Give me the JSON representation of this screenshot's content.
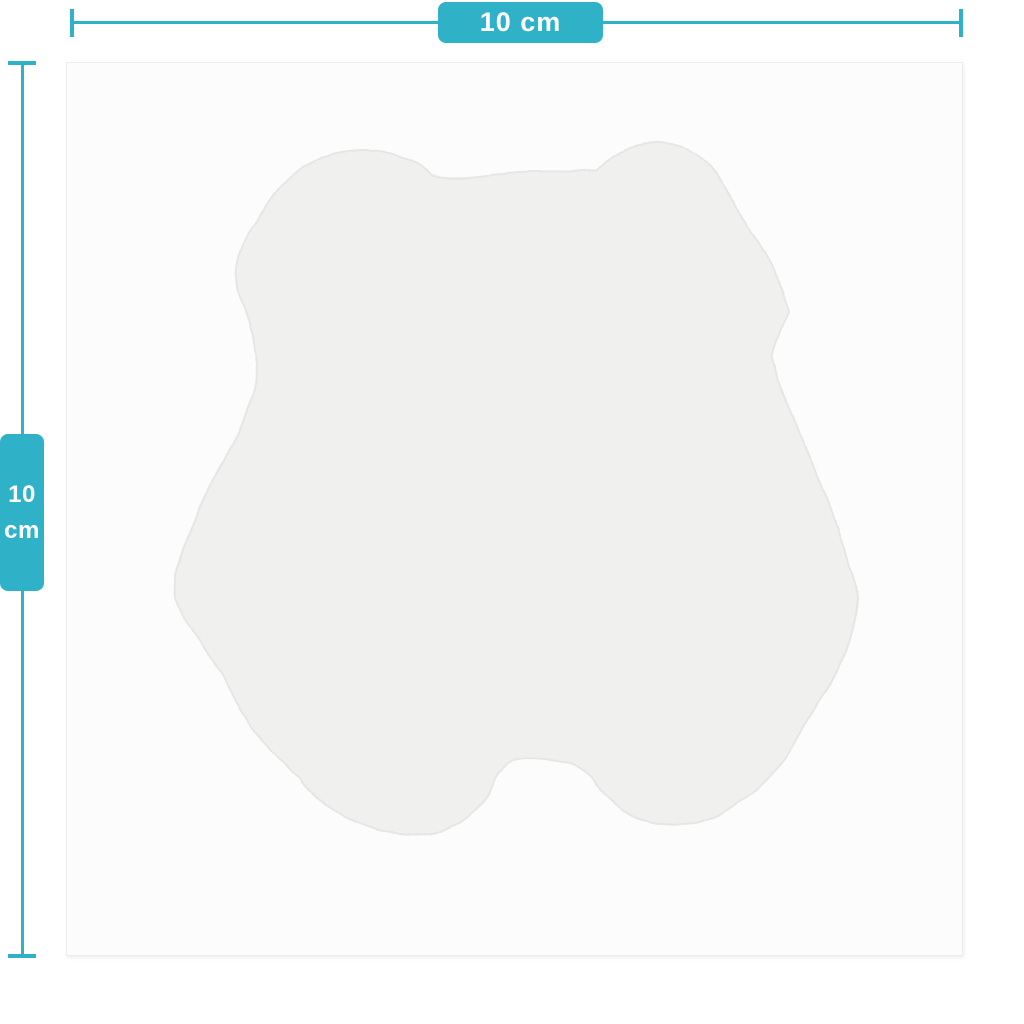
{
  "diagram": {
    "type": "product-dimension-diagram",
    "subject": "bear-shaped sticker / decal silhouette on square sheet",
    "accent_color": "#2fb2c8",
    "canvas_background": "#fcfcfd",
    "canvas_border_color": "#ededee",
    "sticker_fill_color": "#f0f1ef",
    "sticker_edge_color": "#e6e7e5"
  },
  "dimensions": {
    "width": {
      "label": "10 cm",
      "value": "10",
      "unit": "cm"
    },
    "height": {
      "value": "10",
      "unit": "cm"
    }
  }
}
